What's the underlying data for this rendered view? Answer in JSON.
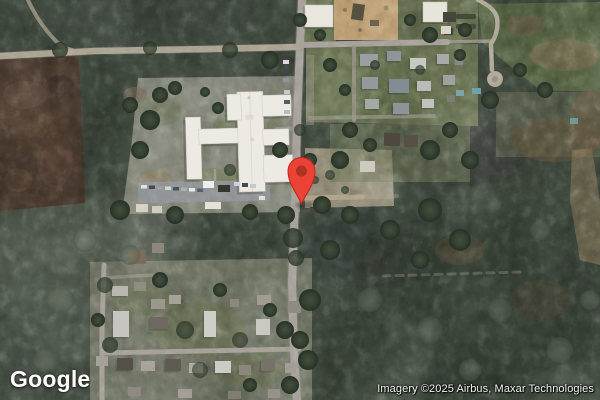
{
  "page": {
    "width": 600,
    "height": 400,
    "view": "satellite-map"
  },
  "map": {
    "logo_text": "Google",
    "attribution_text": "Imagery ©2025 Airbus, Maxar Technologies",
    "marker": {
      "name": "location-pin",
      "body_color": "#EA4335",
      "outline_color": "#C5221F",
      "dot_color": "#B03024"
    },
    "palette": {
      "canopy_base": "#414a3f",
      "field_brown": "#4a3b30",
      "road_gray": "#a8a49d",
      "dirt_road_tan": "#b6a98f",
      "building_white": "#edeae3",
      "sand_lot_tan": "#c7a87c",
      "lawn_green": "#707a57"
    }
  }
}
